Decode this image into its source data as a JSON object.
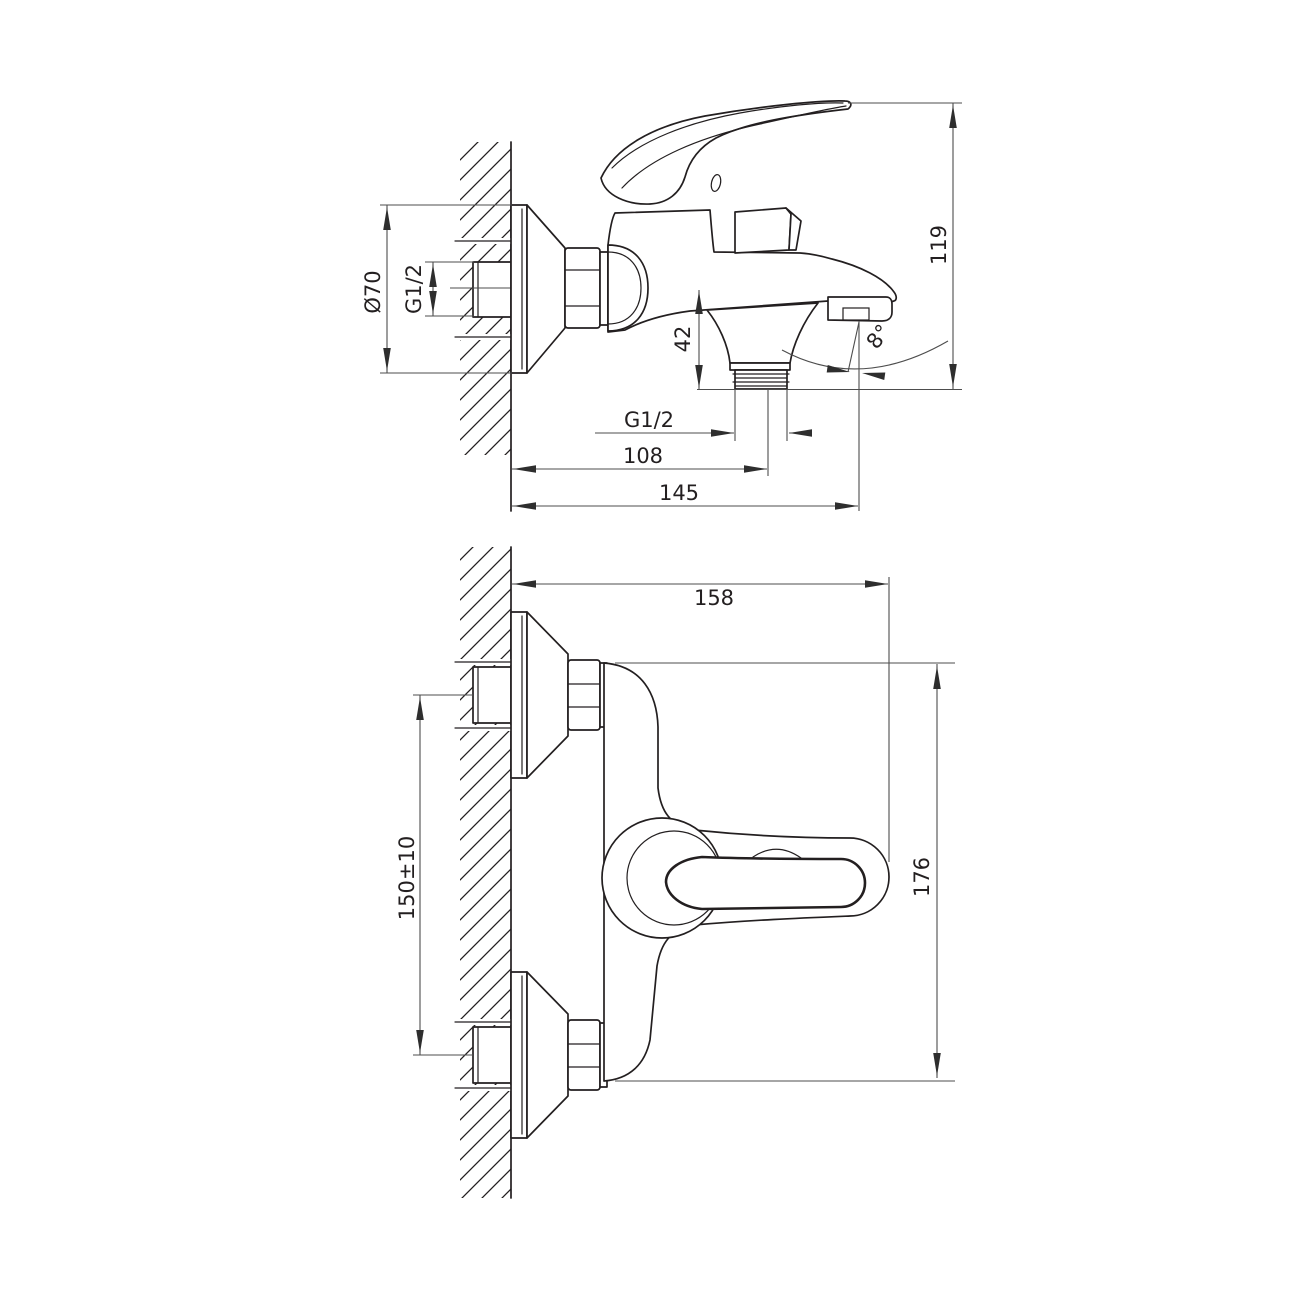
{
  "page": {
    "background": "#ffffff"
  },
  "drawing": {
    "type": "technical-drawing",
    "subject": "wall-mounted single-lever bath mixer tap, side view and plan view with dimensions",
    "line_color": "#231f20",
    "dimension_line_color": "#4d4d4d",
    "units": "mm"
  },
  "labels": {
    "dia70": "Ø70",
    "g12_side": "G1/2",
    "dim42": "42",
    "dim119": "119",
    "g12_bottom": "G1/2",
    "dim108": "108",
    "dim145": "145",
    "angle8": "8°",
    "dim158": "158",
    "dim150": "150±10",
    "dim176": "176"
  }
}
